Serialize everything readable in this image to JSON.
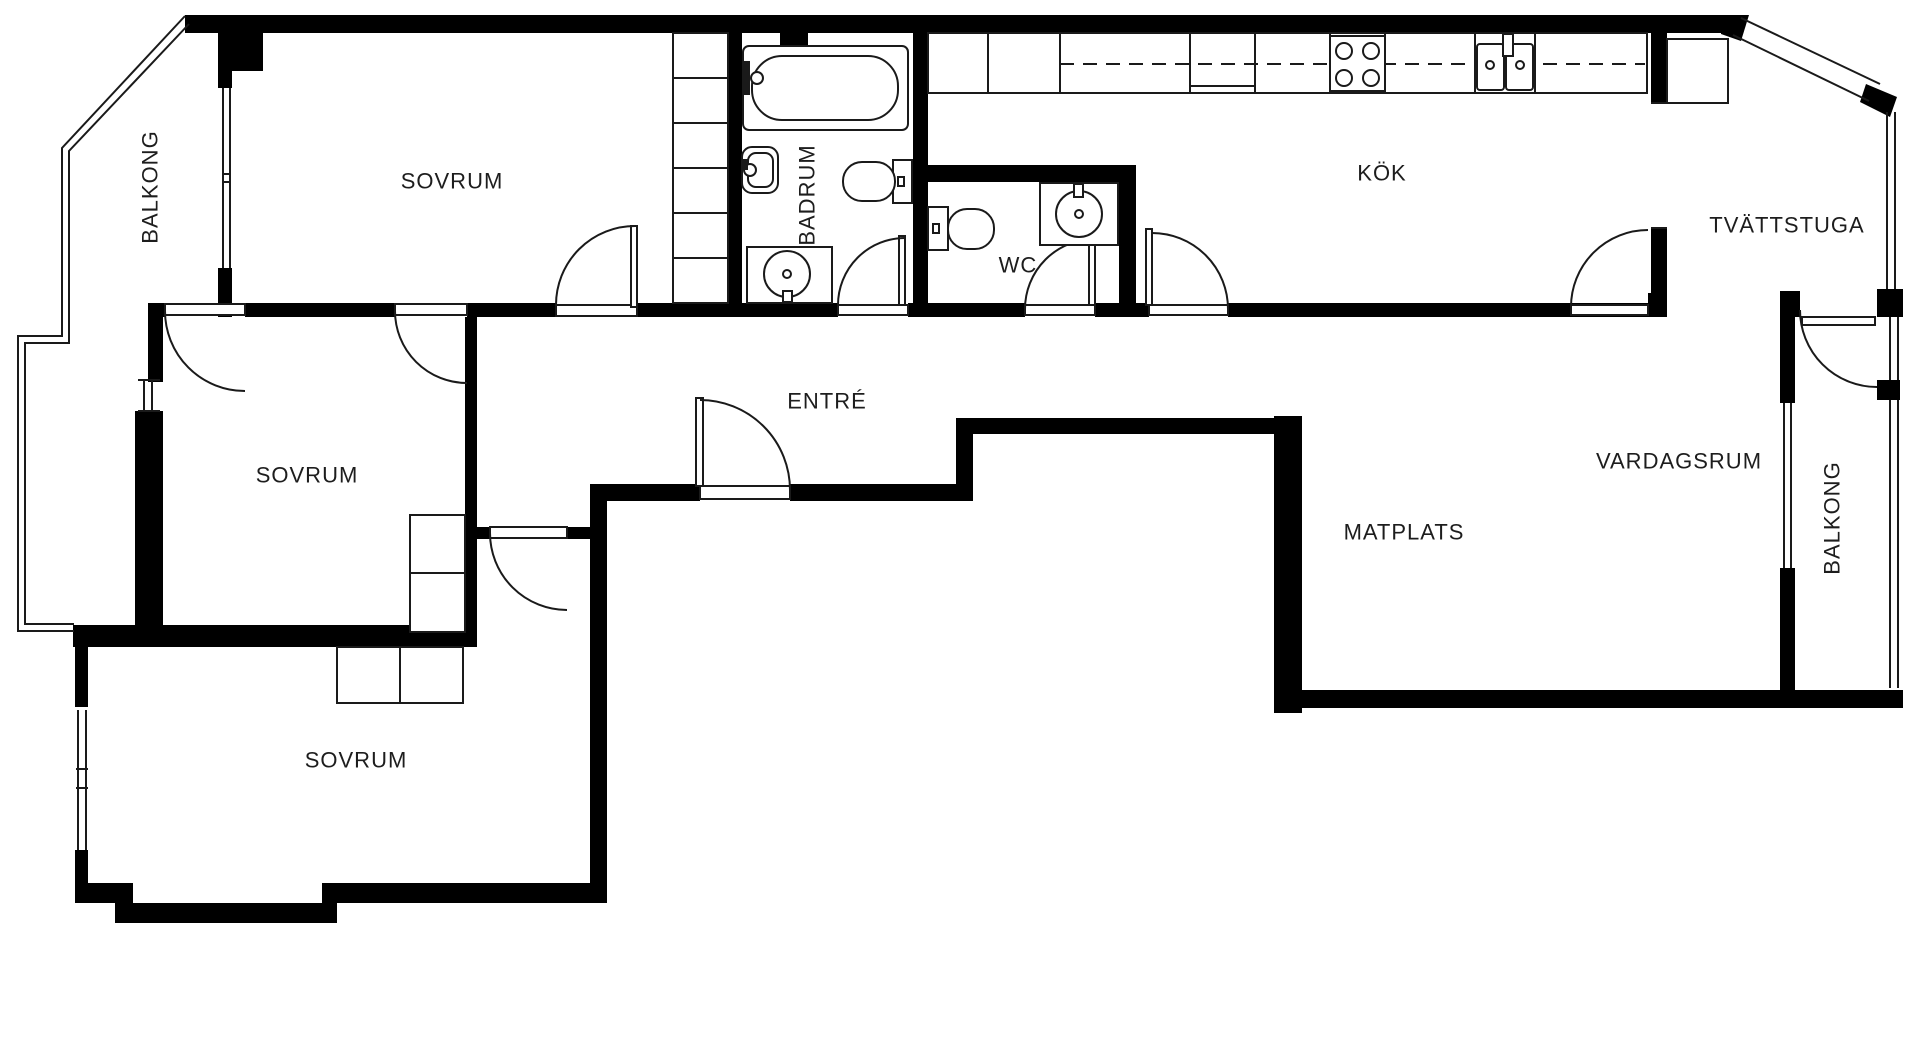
{
  "floorplan": {
    "title": "apartment-floor-plan",
    "colors": {
      "wall": "#000000",
      "line": "#1a1a1a",
      "text": "#1d1d1d",
      "background": "#ffffff"
    },
    "rooms": [
      {
        "id": "sovrum-top",
        "label": "SOVRUM",
        "orientation": "horizontal"
      },
      {
        "id": "balkong-left",
        "label": "BALKONG",
        "orientation": "vertical"
      },
      {
        "id": "badrum",
        "label": "BADRUM",
        "orientation": "vertical"
      },
      {
        "id": "wc",
        "label": "WC",
        "orientation": "horizontal"
      },
      {
        "id": "kok",
        "label": "KÖK",
        "orientation": "horizontal"
      },
      {
        "id": "tvattstuga",
        "label": "TVÄTTSTUGA",
        "orientation": "horizontal"
      },
      {
        "id": "entre",
        "label": "ENTRÉ",
        "orientation": "horizontal"
      },
      {
        "id": "sovrum-middle",
        "label": "SOVRUM",
        "orientation": "horizontal"
      },
      {
        "id": "vardagsrum",
        "label": "VARDAGSRUM",
        "orientation": "horizontal"
      },
      {
        "id": "matplats",
        "label": "MATPLATS",
        "orientation": "horizontal"
      },
      {
        "id": "sovrum-bottom",
        "label": "SOVRUM",
        "orientation": "horizontal"
      },
      {
        "id": "balkong-right",
        "label": "BALKONG",
        "orientation": "vertical"
      }
    ],
    "fixtures": [
      "bathtub",
      "bathroom-wall-sink",
      "bathroom-vanity-sink",
      "bathroom-toilet",
      "wc-toilet",
      "wc-sink",
      "kitchen-counter",
      "stove-4-burners",
      "kitchen-double-sink",
      "laundry-cabinet",
      "wardrobe-shelves",
      "closet-squares",
      "balcony-railing",
      "windows",
      "door-arcs"
    ]
  }
}
